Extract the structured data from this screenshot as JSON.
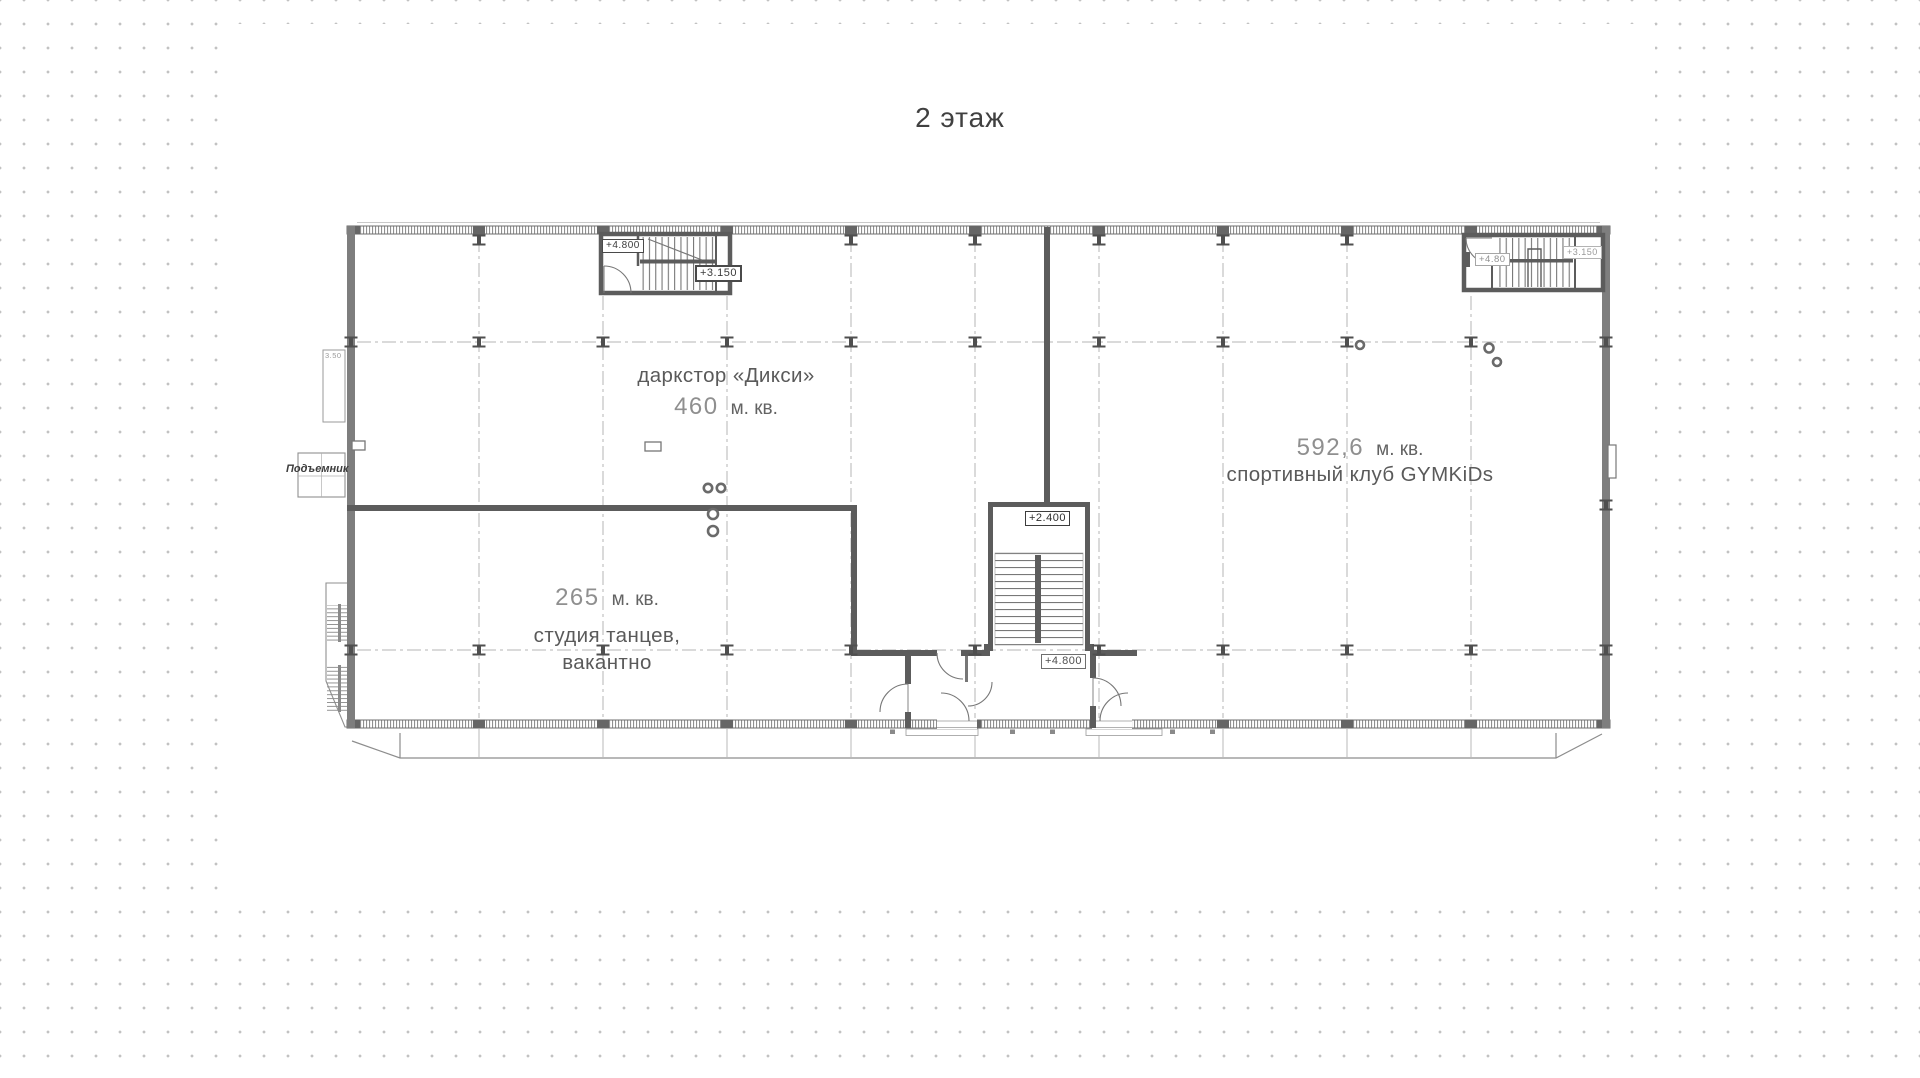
{
  "title": "2 этаж",
  "units": [
    {
      "name": "даркстор «Дикси»",
      "area": "460",
      "unit": "м. кв."
    },
    {
      "area": "592,6",
      "unit": "м. кв.",
      "name": "спортивный клуб GYMKiDs"
    },
    {
      "area": "265",
      "unit": "м. кв.",
      "name": "студия танцев,",
      "status": "вакантно"
    }
  ],
  "marks": {
    "tl_upper": "+4.800",
    "tl_lower": "+3.150",
    "tr_upper": "+4.80",
    "tr_lower": "+3.150",
    "center_upper": "+2.400",
    "center_lower": "+4.800"
  },
  "annotations": {
    "lift": "Подъемник",
    "shaft": "3.50"
  },
  "colors": {
    "wall": "#5c5c5c",
    "solid_wall_fill": "#7e7e7e",
    "grid": "#b5b5b5",
    "room_text": "#5a5a5a",
    "area_number": "#8f8f8f",
    "background_dot": "#c2c2c2"
  }
}
